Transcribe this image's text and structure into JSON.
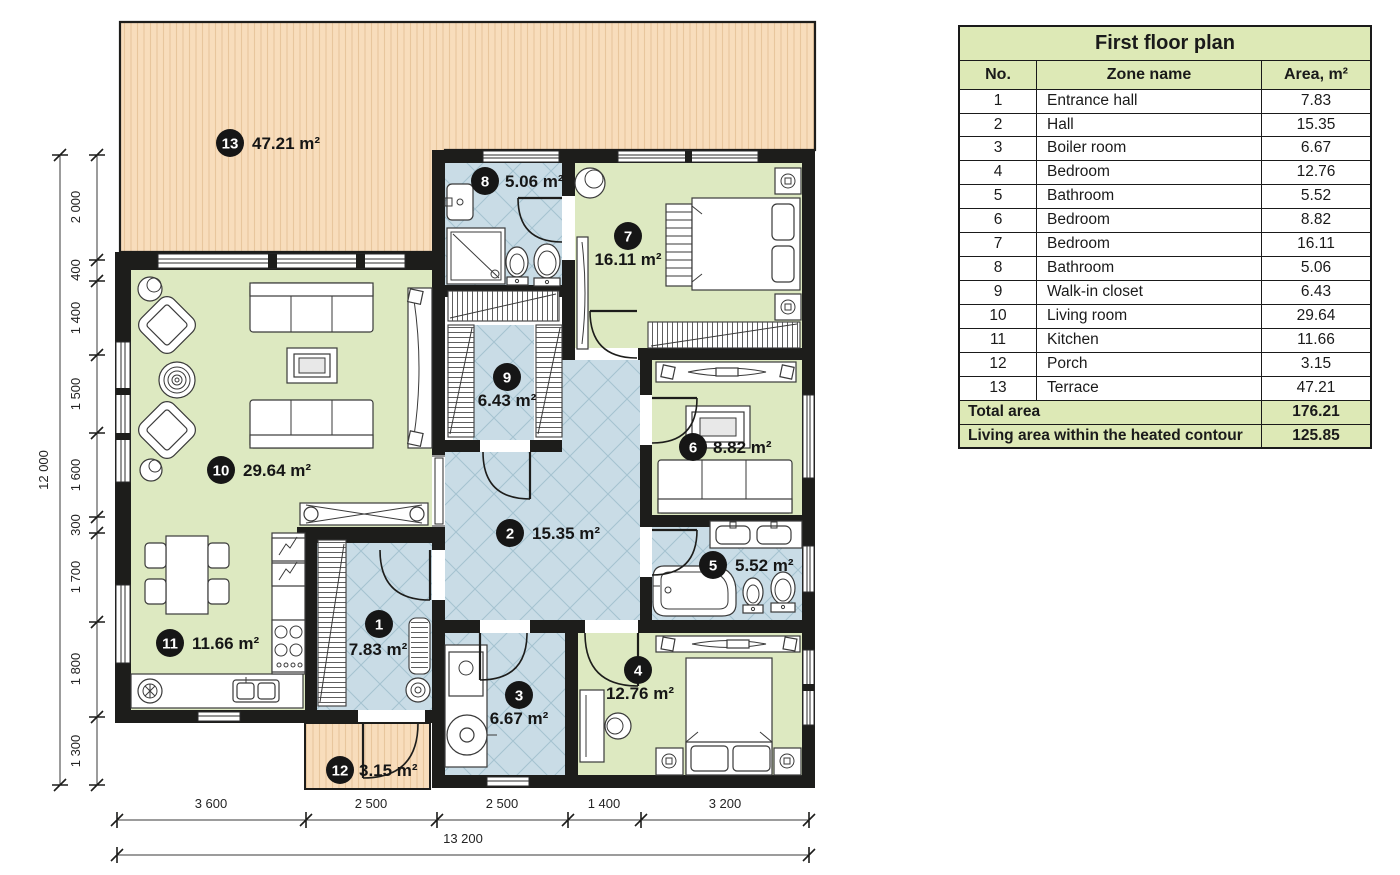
{
  "table": {
    "title": "First floor plan",
    "col_no": "No.",
    "col_zone": "Zone name",
    "col_area": "Area, m²",
    "rows": [
      {
        "no": "1",
        "zone": "Entrance hall",
        "area": "7.83"
      },
      {
        "no": "2",
        "zone": "Hall",
        "area": "15.35"
      },
      {
        "no": "3",
        "zone": "Boiler room",
        "area": "6.67"
      },
      {
        "no": "4",
        "zone": "Bedroom",
        "area": "12.76"
      },
      {
        "no": "5",
        "zone": "Bathroom",
        "area": "5.52"
      },
      {
        "no": "6",
        "zone": "Bedroom",
        "area": "8.82"
      },
      {
        "no": "7",
        "zone": "Bedroom",
        "area": "16.11"
      },
      {
        "no": "8",
        "zone": "Bathroom",
        "area": "5.06"
      },
      {
        "no": "9",
        "zone": "Walk-in closet",
        "area": "6.43"
      },
      {
        "no": "10",
        "zone": "Living room",
        "area": "29.64"
      },
      {
        "no": "11",
        "zone": "Kitchen",
        "area": "11.66"
      },
      {
        "no": "12",
        "zone": "Porch",
        "area": "3.15"
      },
      {
        "no": "13",
        "zone": "Terrace",
        "area": "47.21"
      }
    ],
    "total_label": "Total area",
    "total_value": "176.21",
    "living_label": "Living area within the heated contour",
    "living_value": "125.85"
  },
  "plan": {
    "rooms": [
      {
        "no": "1",
        "area": "7.83 m²"
      },
      {
        "no": "2",
        "area": "15.35 m²"
      },
      {
        "no": "3",
        "area": "6.67 m²"
      },
      {
        "no": "4",
        "area": "12.76 m²"
      },
      {
        "no": "5",
        "area": "5.52 m²"
      },
      {
        "no": "6",
        "area": "8.82 m²"
      },
      {
        "no": "7",
        "area": "16.11 m²"
      },
      {
        "no": "8",
        "area": "5.06 m²"
      },
      {
        "no": "9",
        "area": "6.43 m²"
      },
      {
        "no": "10",
        "area": "29.64 m²"
      },
      {
        "no": "11",
        "area": "11.66 m²"
      },
      {
        "no": "12",
        "area": "3.15 m²"
      },
      {
        "no": "13",
        "area": "47.21 m²"
      }
    ],
    "dims_left": [
      "2 000",
      "400",
      "1 400",
      "1 500",
      "1 600",
      "300",
      "1 700",
      "1 800",
      "1 300"
    ],
    "dims_left_total": "12 000",
    "dims_bottom": [
      "3 600",
      "2 500",
      "2 500",
      "1 400",
      "3 200"
    ],
    "dims_bottom_total": "13 200"
  },
  "colors": {
    "wall": "#1d1d1b",
    "room_green": "#dde9c1",
    "room_blue": "#c9dce6",
    "tile_line": "#a5c3d0",
    "terrace_tan": "#f8ddbc",
    "terrace_stripe": "#e8c69d",
    "table_green": "#dde9b6"
  }
}
